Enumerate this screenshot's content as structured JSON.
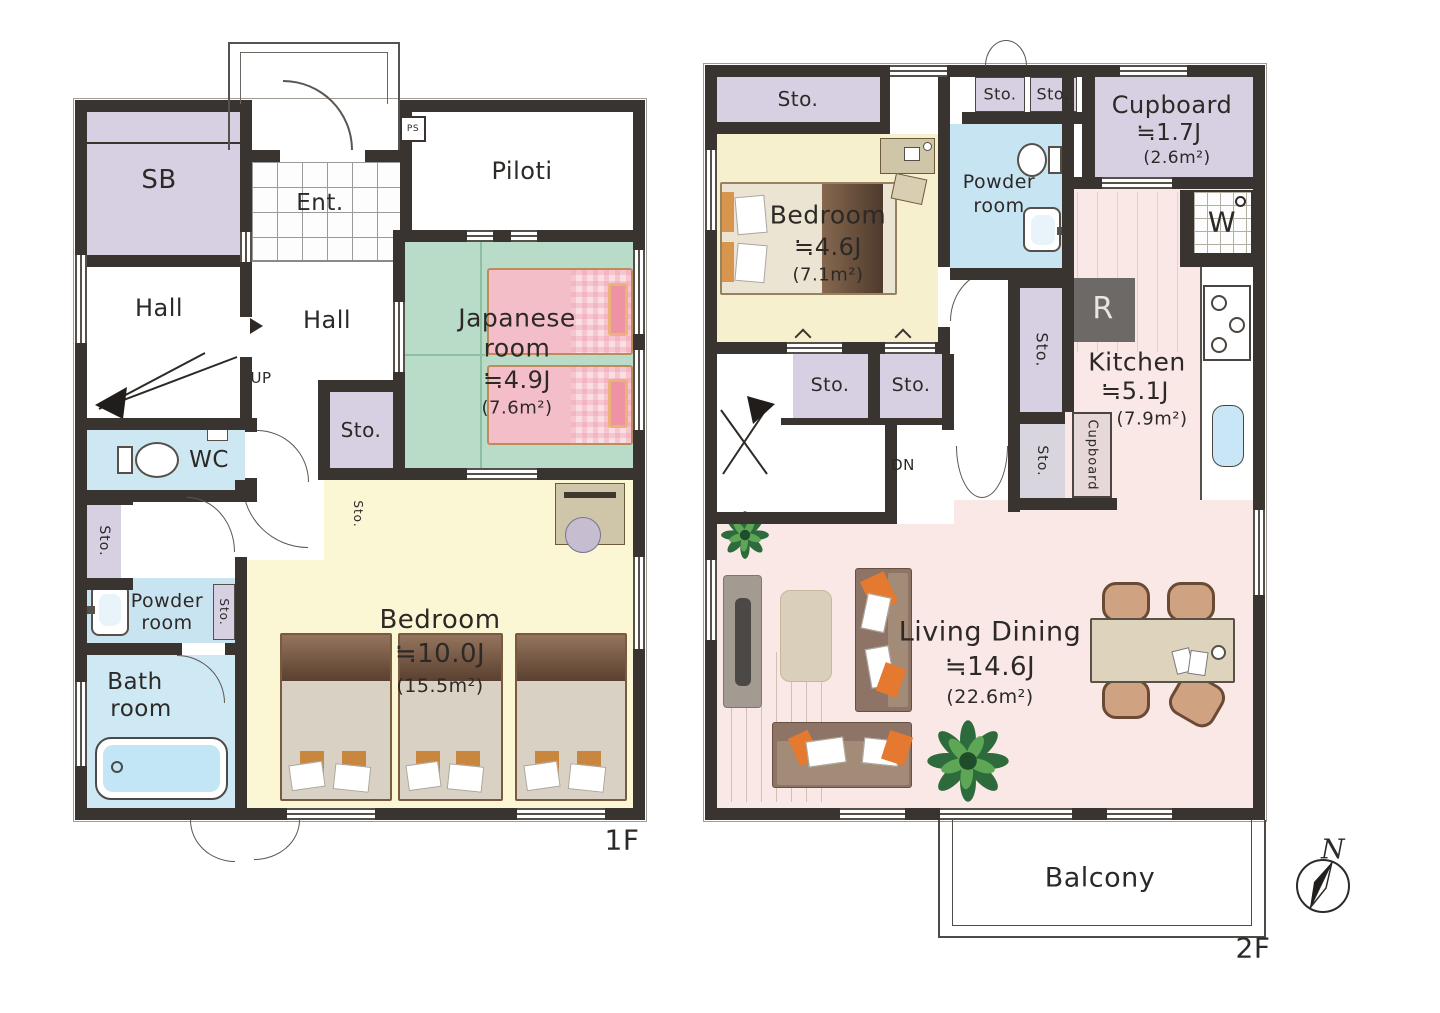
{
  "palette": {
    "wall": "#39342f",
    "storage_purple": "#d6d0e2",
    "water_blue": "#cde8f3",
    "tatami_green": "#b9dcc9",
    "bedroom_yellow": "#fbf7d5",
    "living_pink": "#f9e8e5",
    "accent_orange": "#e5792f"
  },
  "f1": {
    "floor": "1F",
    "sb": "SB",
    "hall": "Hall",
    "hall2": "Hall",
    "ent": "Ent.",
    "piloti": "Piloti",
    "ps": "PS",
    "up": "UP",
    "wc": "WC",
    "sto": "Sto.",
    "powder1": "Powder",
    "powder2": "room",
    "bath1": "Bath",
    "bath2": "room",
    "jp1": "Japanese",
    "jp2": "room",
    "jp_size": "≒4.9J",
    "jp_area": "(7.6m²)",
    "bed": "Bedroom",
    "bed_size": "≒10.0J",
    "bed_area": "(15.5m²)"
  },
  "f2": {
    "floor": "2F",
    "sto": "Sto.",
    "dn": "DN",
    "washer": "W",
    "fridge": "R",
    "powder1": "Powder",
    "powder2": "room",
    "bed": "Bedroom",
    "bed_size": "≒4.6J",
    "bed_area": "(7.1m²)",
    "cup": "Cupboard",
    "cup_size": "≒1.7J",
    "cup_area": "(2.6m²)",
    "cupv": "Cupboard",
    "kitchen": "Kitchen",
    "kitchen_size": "≒5.1J",
    "kitchen_area": "(7.9m²)",
    "living": "Living Dining",
    "living_size": "≒14.6J",
    "living_area": "(22.6m²)",
    "balcony": "Balcony"
  },
  "compass": {
    "n": "N"
  }
}
